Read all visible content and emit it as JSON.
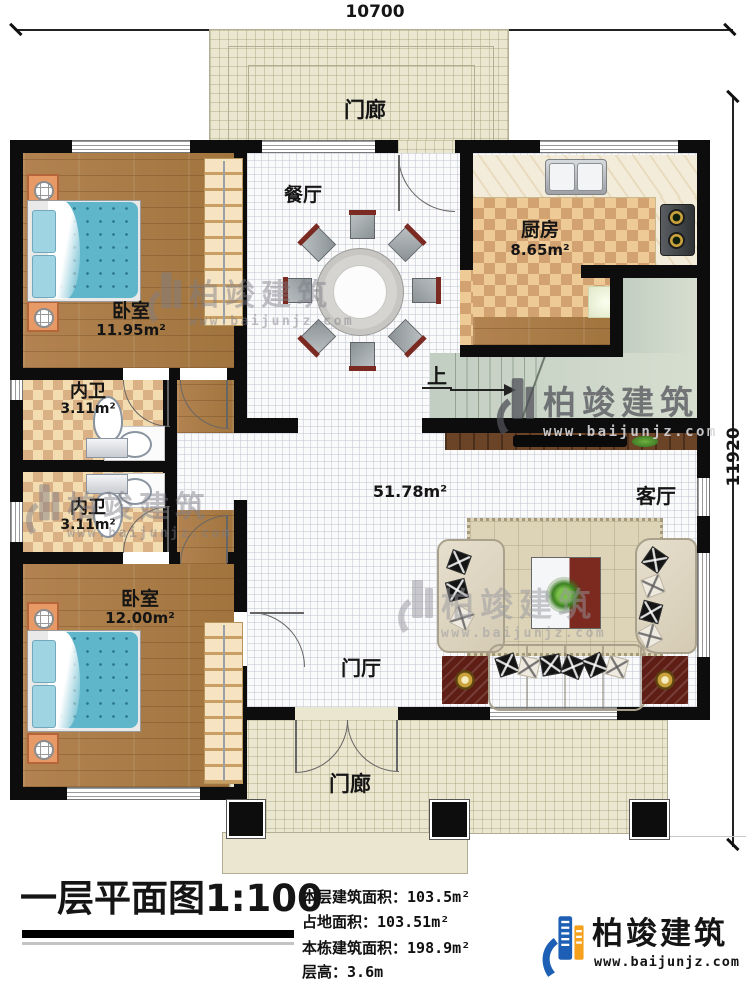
{
  "dimensions": {
    "width": "10700",
    "height": "11920"
  },
  "rooms": {
    "porch_top": "门廊",
    "dining": "餐厅",
    "kitchen": {
      "name": "厨房",
      "area": "8.65m²"
    },
    "bedroom1": {
      "name": "卧室",
      "area": "11.95m²"
    },
    "bath1": {
      "name": "内卫",
      "area": "3.11m²"
    },
    "bath2": {
      "name": "内卫",
      "area": "3.11m²"
    },
    "bedroom2": {
      "name": "卧室",
      "area": "12.00m²"
    },
    "living": "客厅",
    "hall": "门厅",
    "porch_bottom": "门廊",
    "open_area": "51.78m²",
    "stairs_up": "上"
  },
  "title_block": {
    "title": "一层平面图1:100",
    "stats": [
      {
        "label": "本层建筑面积：",
        "value": "103.5m²"
      },
      {
        "label": "占地面积：",
        "value": "103.51m²"
      },
      {
        "label": "本栋建筑面积：",
        "value": "198.9m²"
      },
      {
        "label": "层高：",
        "value": "3.6m"
      }
    ]
  },
  "brand": {
    "name": "柏竣建筑",
    "site": "www.baijunjz.com"
  },
  "colors": {
    "wall": "#0d0d0d",
    "brand_blue": "#1d5fb4",
    "brand_orange": "#f5a11d"
  }
}
